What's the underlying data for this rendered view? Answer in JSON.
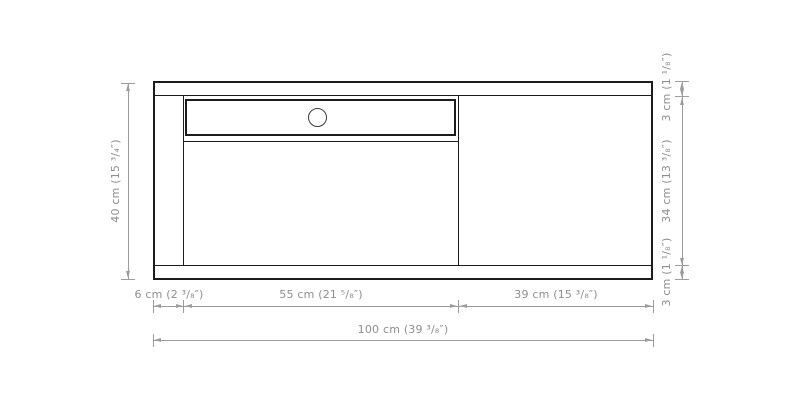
{
  "dimensions": {
    "left_total_height": "40 cm (15 ³/₄″)",
    "bottom_left_segment": "6 cm (2 ³/₈″)",
    "bottom_middle_segment": "55 cm (21 ⁵/₈″)",
    "bottom_right_segment": "39 cm (15 ³/₈″)",
    "bottom_total_width": "100 cm (39 ³/₈″)",
    "right_top_segment": "3 cm (1 ¹/₈″)",
    "right_middle_segment": "34 cm (13 ³/₈″)",
    "right_bottom_segment": "3 cm (1 ¹/₈″)"
  },
  "colors": {
    "outline": "#1c1c1c",
    "dimension_line": "#9c9c9c",
    "dimension_text": "#8e8e8e",
    "background": "#ffffff"
  }
}
